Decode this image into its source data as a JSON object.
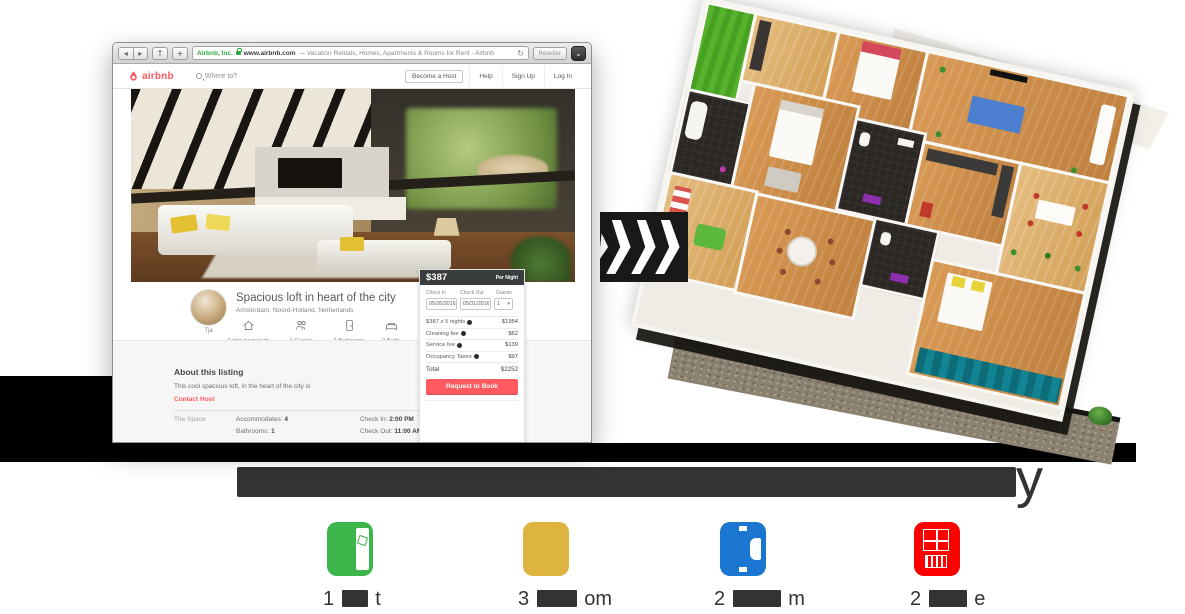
{
  "browser": {
    "chrome": {
      "back_icon": "◂",
      "forward_icon": "▸",
      "share_icon": "↑",
      "add_icon": "+",
      "secure_site": "Airbnb, Inc.",
      "domain": "www.airbnb.com",
      "page_title": "— Vacation Rentals, Homes, Apartments & Rooms for Rent - Airbnb",
      "refresh_icon": "↻",
      "reader_label": "Reader",
      "overflow_icon": "⌄"
    },
    "navbar": {
      "brand": "airbnb",
      "search_placeholder": "Where to?",
      "become_host": "Become a Host",
      "help": "Help",
      "sign_up": "Sign Up",
      "log_in": "Log In"
    },
    "listing": {
      "host_name": "Tja",
      "title": "Spacious loft in heart of the city",
      "location": "Amsterdam, Noord-Holland, Netherlands",
      "facts": [
        {
          "icon": "home-icon",
          "label": "Entire home/apt"
        },
        {
          "icon": "guests-icon",
          "label": "4 Guests"
        },
        {
          "icon": "door-icon",
          "label": "2 Bedrooms"
        },
        {
          "icon": "bed-icon",
          "label": "2 Beds"
        }
      ],
      "about_heading": "About this listing",
      "about_text": "This cool spacious loft, in the heart of the city is",
      "contact_host": "Contact Host",
      "space_label": "The Space",
      "accommodates_label": "Accommodates:",
      "accommodates_value": "4",
      "bathrooms_label": "Bathrooms:",
      "bathrooms_value": "1",
      "check_in_label": "Check In:",
      "check_in_value": "2:00 PM",
      "check_out_label": "Check Out:",
      "check_out_value": "11:00 AM"
    },
    "booking": {
      "price": "$387",
      "per_night": "Per Night",
      "check_in_label": "Check In",
      "check_out_label": "Check Out",
      "guests_label": "Guests",
      "check_in_value": "05/26/2016",
      "check_out_value": "05/31/2016",
      "guests_value": "1",
      "guests_caret": "▾",
      "fees": [
        {
          "label": "$387 x 5 nights",
          "value": "$1954"
        },
        {
          "label": "Cleaning fee",
          "value": "$62"
        },
        {
          "label": "Service fee",
          "value": "$139"
        },
        {
          "label": "Occupancy Taxes",
          "value": "$97"
        }
      ],
      "total_label": "Total",
      "total_value": "$2252",
      "cta": "Request to Book"
    }
  },
  "transform_arrow": {
    "icon": "triple-chevron-right"
  },
  "caption": {
    "redacted": true,
    "visible_text": "y"
  },
  "legend": {
    "items": [
      {
        "name": "green",
        "color": "#3cb54a",
        "count": "1",
        "visible_suffix": "t",
        "redacted": true
      },
      {
        "name": "gold",
        "color": "#deb440",
        "count": "3",
        "visible_suffix": "om",
        "redacted": true
      },
      {
        "name": "blue",
        "color": "#1b76d1",
        "count": "2",
        "visible_suffix": "m",
        "redacted": true
      },
      {
        "name": "red",
        "color": "#fd0100",
        "count": "2",
        "visible_suffix": "e",
        "redacted": true
      }
    ]
  },
  "colors": {
    "airbnb_red": "#ff5a5f",
    "booking_header": "#3a3d3e",
    "band_black": "#000000",
    "caption_gray": "#333333"
  }
}
